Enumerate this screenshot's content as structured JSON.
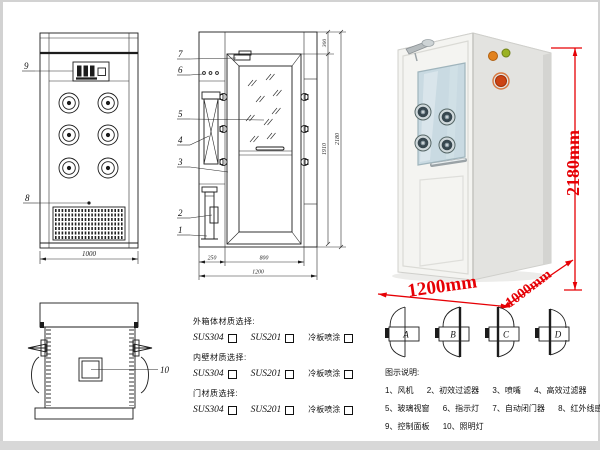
{
  "front_view": {
    "callout_9": "9",
    "callout_8": "8",
    "dim_width": "1000"
  },
  "section_view": {
    "callouts": [
      "7",
      "6",
      "5",
      "4",
      "3",
      "2",
      "1"
    ],
    "dim_top": "300",
    "dim_door_height": "1910",
    "dim_total_height": "2180",
    "dim_left": "250",
    "dim_door_width": "800",
    "dim_total_width": "1200"
  },
  "photo": {
    "dim_height": "2180mm",
    "dim_width": "1200mm",
    "dim_depth": "1000mm",
    "dim_color": "#e60005"
  },
  "top_view": {
    "callout_10": "10"
  },
  "materials": {
    "groups": [
      {
        "title": "外箱体材质选择:",
        "opt1": "SUS304",
        "opt2": "SUS201",
        "opt3": "冷板喷涂"
      },
      {
        "title": "内壁材质选择:",
        "opt1": "SUS304",
        "opt2": "SUS201",
        "opt3": "冷板喷涂"
      },
      {
        "title": "门材质选择:",
        "opt1": "SUS304",
        "opt2": "SUS201",
        "opt3": "冷板喷涂"
      }
    ]
  },
  "door_options": {
    "a": "A",
    "b": "B",
    "c": "C",
    "d": "D"
  },
  "legend": {
    "title": "图示说明:",
    "items": [
      "1、风机",
      "2、初效过滤器",
      "3、喷嘴",
      "4、高效过滤器",
      "5、玻璃视窗",
      "6、指示灯",
      "7、自动闭门器",
      "8、红外线感应器",
      "9、控制面板",
      "10、照明灯"
    ]
  }
}
